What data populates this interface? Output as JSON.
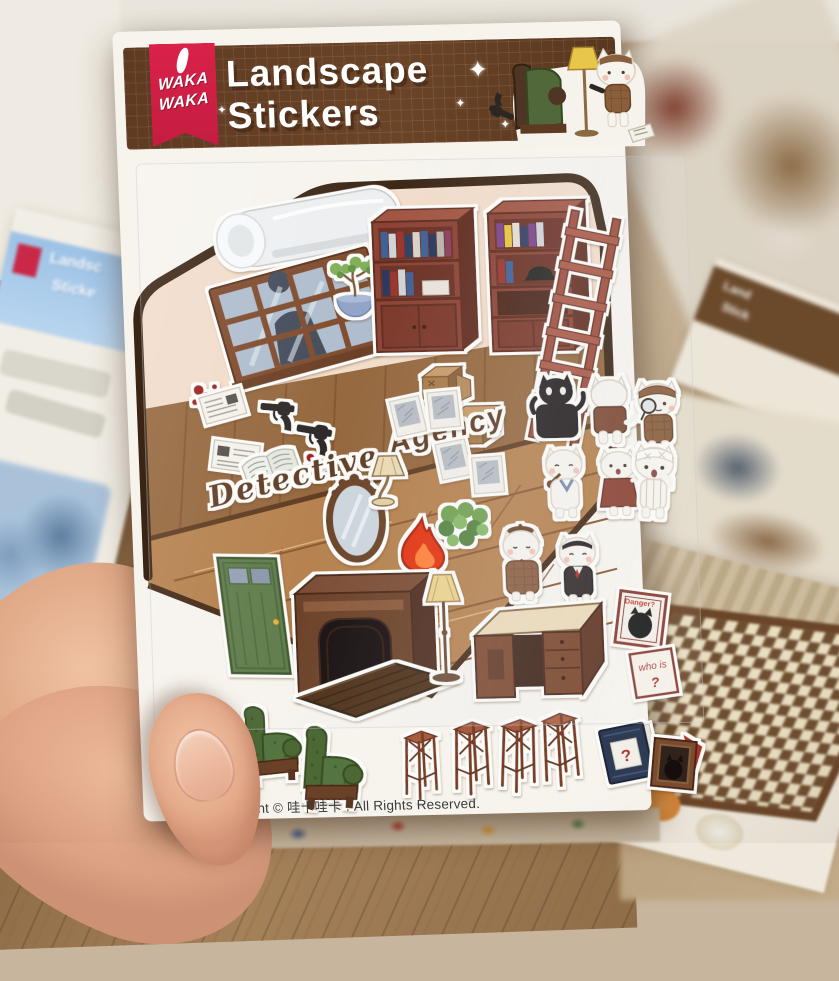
{
  "photo": {
    "description": "hand holding a detective-themed sticker sheet above a wooden desk scattered with more sticker sheets"
  },
  "sheet": {
    "brand_line1": "WAKA",
    "brand_line2": "WAKA",
    "title_line1": "Landscape",
    "title_line2": "Stickers",
    "sparkle": "✦",
    "room_text_line1": "Detective",
    "room_text_line2": "Agency",
    "poster_danger_text": "Danger?",
    "note_whois_line1": "who is",
    "note_whois_line2": "?",
    "book_question_mark": "?",
    "copyright": "Copyright © 哇卡哇卡 . All Rights Reserved.",
    "colors": {
      "header_brown": "#5e3a21",
      "ribbon_red": "#d8224a",
      "sheet_white": "#f7f4ee",
      "wall_cream": "#f2dcca",
      "wainscot_brown": "#94663c",
      "floor_brown": "#b5804c",
      "outline_brown": "#3a2413",
      "bookshelf_red": "#8a4130",
      "door_green": "#5f7c4c",
      "armchair_green": "#4c6836",
      "flame_red": "#e23110"
    }
  },
  "background": {
    "left_sheet_title_partial1": "Landsc",
    "left_sheet_title_partial2": "Sticke",
    "right_sheet_title_partial1": "Land",
    "right_sheet_title_partial2": "Stick"
  },
  "stickers": {
    "items": [
      "air-conditioner",
      "window-with-silhouette",
      "blood-splatter",
      "bonsai-plant",
      "bookshelf-with-cabinet",
      "bookshelf-with-books",
      "wooden-ladder",
      "cardboard-boxes",
      "black-cat",
      "white-cat-back-view",
      "detective-cat-with-monocle",
      "newspaper",
      "open-book",
      "revolver",
      "detective-agency-wall-text",
      "oval-mirror",
      "table-lamp",
      "flame",
      "green-bush",
      "polaroid-photo",
      "cat-with-pipe",
      "cat-in-dress",
      "cat-with-beret-and-plaid-coat",
      "butler-cat",
      "bandaged-cat",
      "green-door",
      "fireplace",
      "trapdoor",
      "floor-lamp",
      "writing-desk",
      "danger-poster",
      "who-is-note",
      "mystery-book",
      "framed-black-cat",
      "green-armchair",
      "bar-stool"
    ]
  }
}
